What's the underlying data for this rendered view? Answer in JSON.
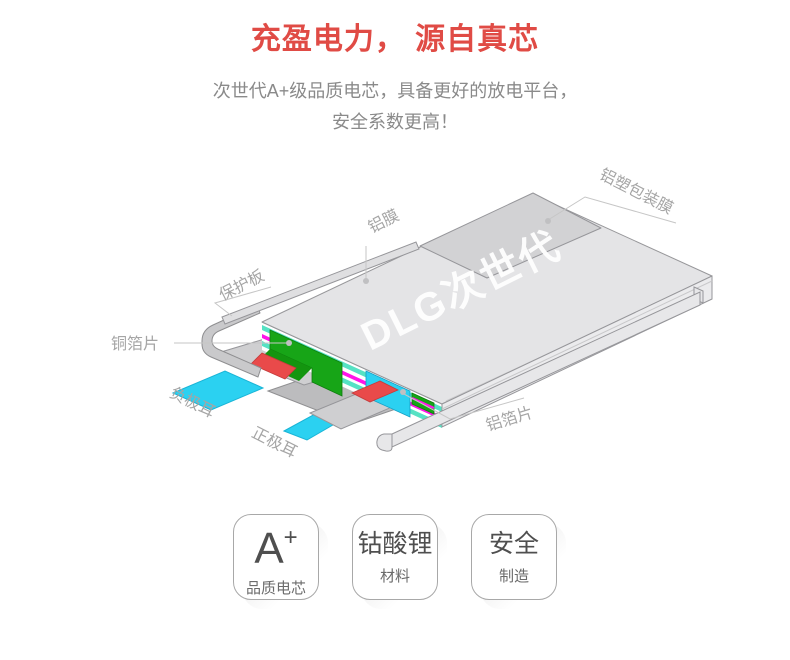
{
  "header": {
    "title": "充盈电力， 源自真芯",
    "subtitle_line1": "次世代A+级品质电芯，具备更好的放电平台，",
    "subtitle_line2": "安全系数更高！"
  },
  "diagram": {
    "logo_text": "DLG次世代",
    "labels": {
      "aluminum_film": "铝膜",
      "aluminum_plastic_packaging_film": "铝塑包装膜",
      "protection_board": "保护板",
      "copper_foil_sheet": "铜箔片",
      "negative_tab": "负极耳",
      "positive_tab": "正极耳",
      "aluminum_foil_sheet": "铝箔片"
    },
    "colors": {
      "body_gray": "#e4e4e6",
      "flap_gray": "#d2d2d4",
      "tab_cyan": "#2bd1f1",
      "pcb_green": "#17a517",
      "separator_magenta": "#ff14e8",
      "layer_teal": "#56e2c4",
      "pad_red": "#e94a4a",
      "label_gray": "#a5a5a5"
    }
  },
  "badges": [
    {
      "title": "A",
      "superscript": "+",
      "subtitle": "品质电芯"
    },
    {
      "title": "钴酸锂",
      "superscript": "",
      "subtitle": "材料"
    },
    {
      "title": "安全",
      "superscript": "",
      "subtitle": "制造"
    }
  ],
  "accent_color": "#e04b45"
}
